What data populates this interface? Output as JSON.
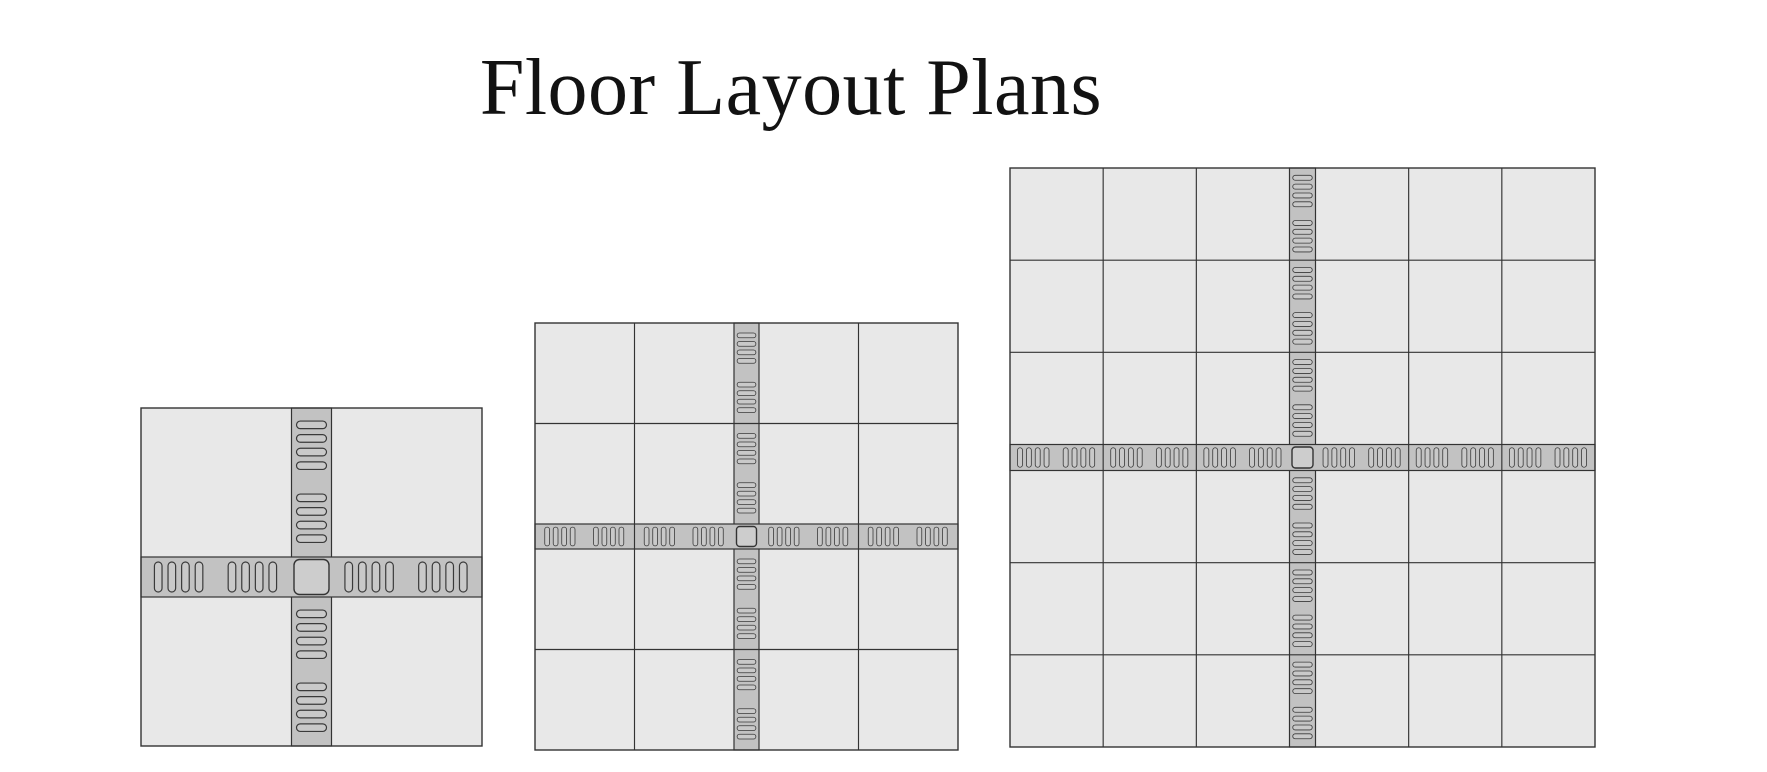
{
  "page": {
    "title": "Floor Layout Plans",
    "background": "#ffffff",
    "width": 1767,
    "height": 772
  },
  "colors": {
    "tile_fill": "#e8e8e8",
    "grid_line": "#333333",
    "corridor_fill": "#c2c2c2",
    "corridor_line": "#333333",
    "hatch_fill": "#c9c9c9",
    "hatch_line": "#3a3a3a",
    "center_fill": "#cdcdcd",
    "title_color": "#121212"
  },
  "plans": [
    {
      "label": "2x2",
      "grid_size": 2,
      "x": 141,
      "y": 408,
      "width": 341,
      "height": 338,
      "corridor_width": 40
    },
    {
      "label": "4x4",
      "grid_size": 4,
      "x": 535,
      "y": 323,
      "width": 423,
      "height": 427,
      "corridor_width": 25
    },
    {
      "label": "6x6",
      "grid_size": 6,
      "x": 1010,
      "y": 168,
      "width": 585,
      "height": 579,
      "corridor_width": 26
    }
  ],
  "hatch": {
    "pills_per_group": 4,
    "groups_per_tile_span": 2,
    "group_positions": [
      0.25,
      0.74
    ],
    "pill_length_ratio": 0.75,
    "pill_thickness_ratio": 0.19,
    "pill_pitch_ratio": 0.34,
    "center_square_inset": 5,
    "center_square_radius_ratio": 0.16
  }
}
